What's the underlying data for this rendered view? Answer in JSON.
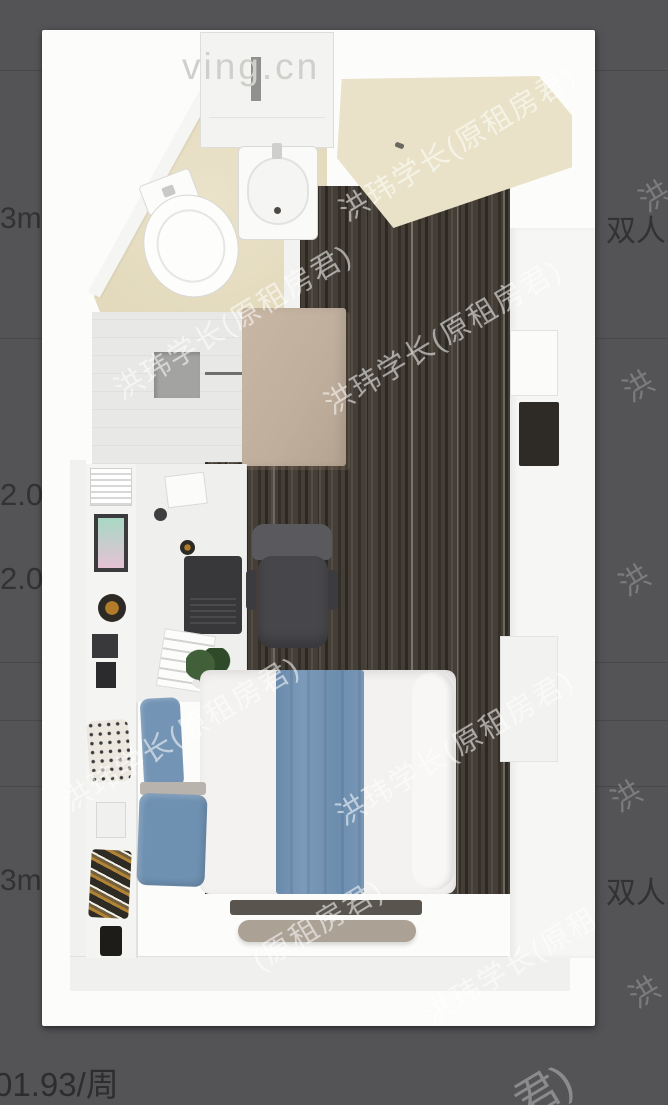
{
  "viewer": {
    "floorplan": {
      "watermark_site": "ving.cn",
      "watermark_brand": "洪玮学长(原租房君)",
      "watermark_brand_fragment": "(原租房君)",
      "colors": {
        "page_background": "#545457",
        "carpet_dark": "#443e36",
        "bed_runner_blue": "#7191b2",
        "pillow_blue": "#6e90b1",
        "wardrobe_tan": "#bfae9c",
        "bathroom_floor_beige": "#e5ddc2",
        "entry_floor_beige": "#e9e2c8"
      }
    },
    "background_list": {
      "area_top": "3m²",
      "occupancy_top": "双人入",
      "price_fragment_1": "2.0",
      "price_fragment_2": "2.0",
      "area_bottom": "3m²",
      "occupancy_bottom": "双人入",
      "price_per_week": "01.93/周",
      "watermark_char": "洪",
      "watermark_tail": "君)"
    }
  }
}
